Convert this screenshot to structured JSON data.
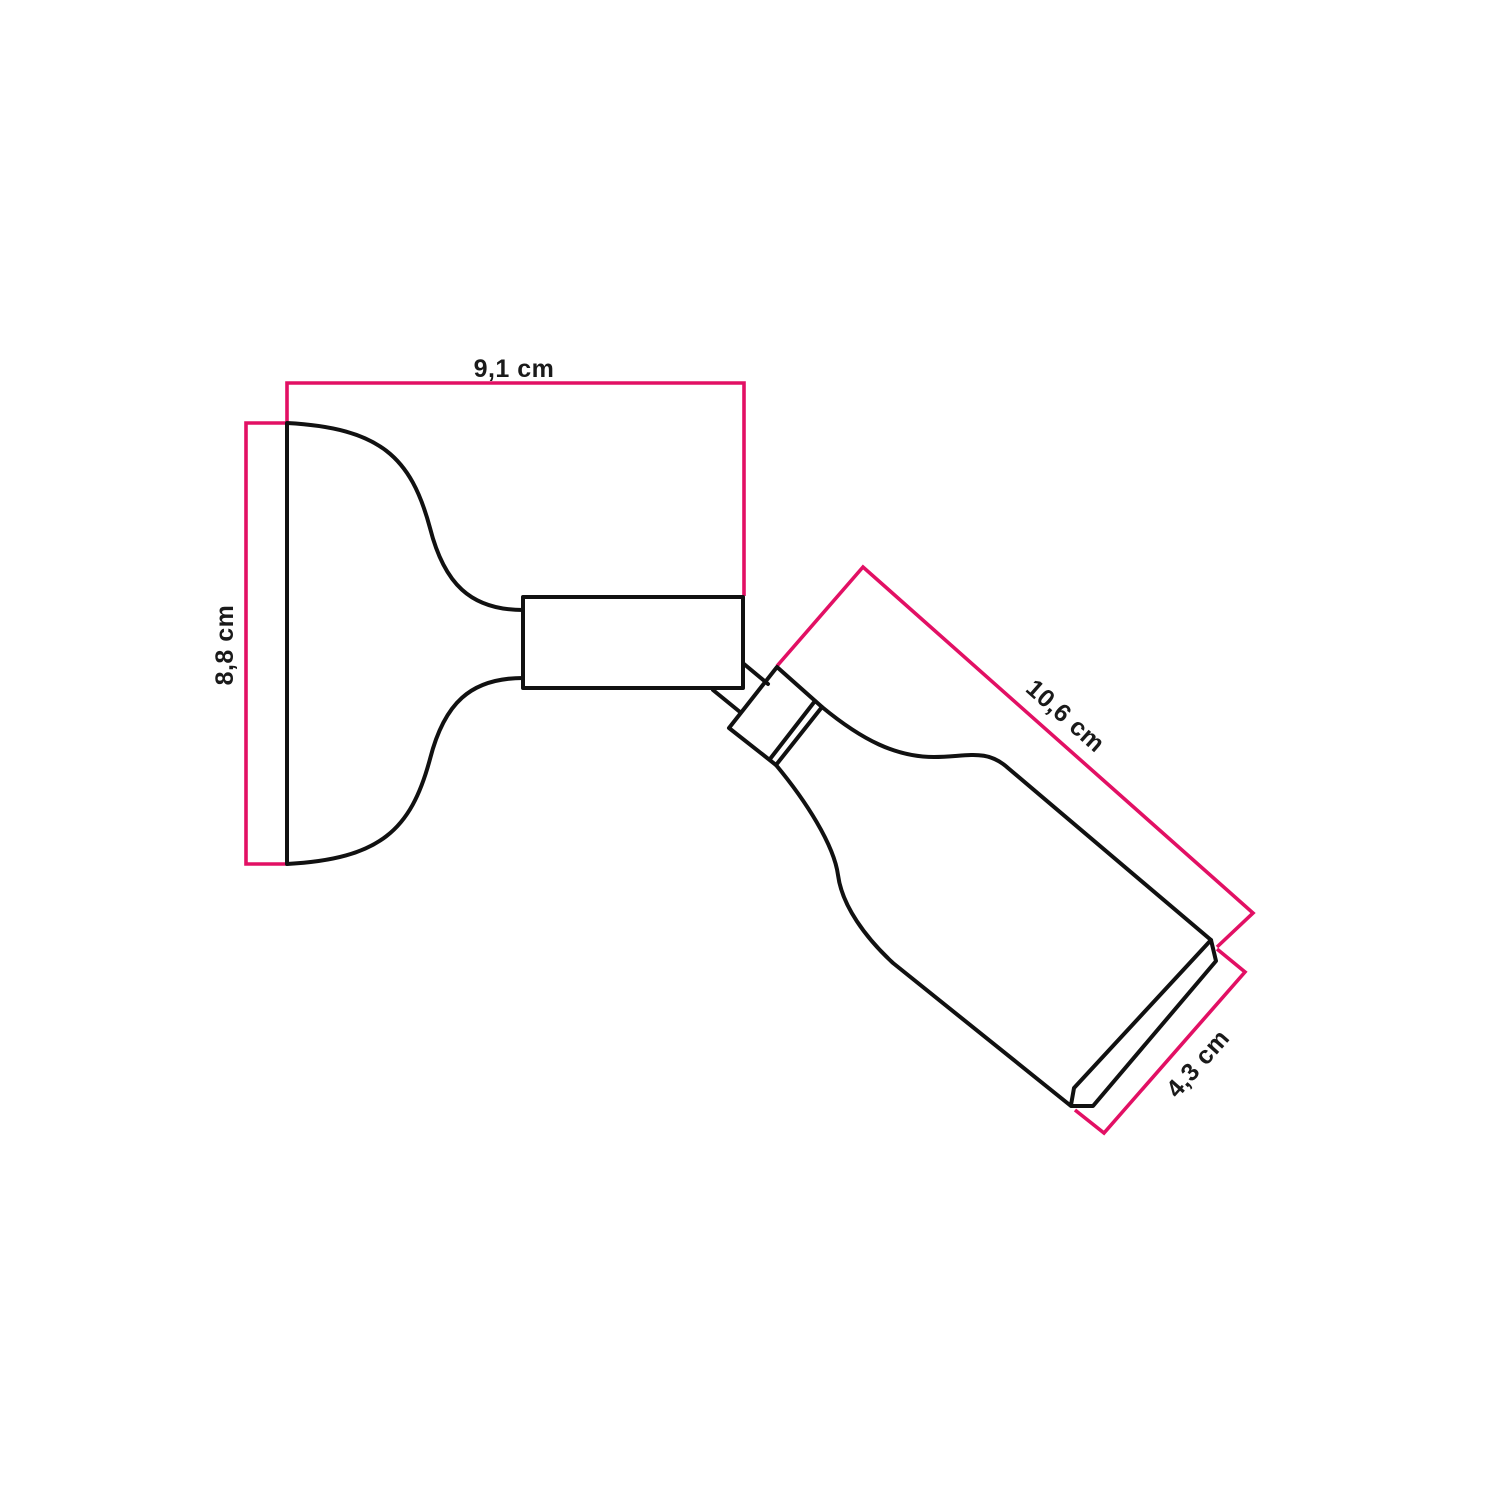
{
  "colors": {
    "accent": "#e21064",
    "line": "#111111",
    "label": "#1a1a1a",
    "background": "#ffffff"
  },
  "diagram": {
    "type": "product-dimension-drawing",
    "subject": "adjustable wall lamp with tilted cylindrical lamp holder",
    "unit": "cm",
    "labels": {
      "depth": "9,1 cm",
      "plate": "8,8 cm",
      "holder_length": "10,6 cm",
      "holder_diameter": "4,3 cm"
    }
  }
}
